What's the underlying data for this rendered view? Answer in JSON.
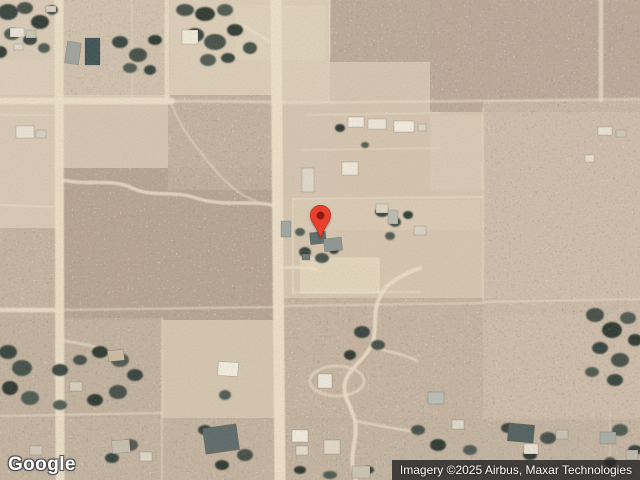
{
  "page": {
    "width": 640,
    "height": 480,
    "view": "satellite-map"
  },
  "logo": {
    "text": "Google"
  },
  "attribution": {
    "text": "Imagery ©2025 Airbus, Maxar Technologies",
    "background": "#242424",
    "text_color": "#ffffff"
  },
  "map": {
    "type": "satellite",
    "marker": {
      "name": "location-pin",
      "x": 320,
      "tip_y": 240,
      "width": 23,
      "height": 36,
      "color": "#e8402d",
      "stroke": "#b32b1a",
      "dot_color": "#8e1a0c"
    },
    "palette": {
      "terrain_base": "#d5c5b2",
      "road": "#ecdfc8",
      "scrub_dark": "#5c4d3f",
      "scrub_light": "#f0e5d2",
      "tree": "#2e3b36",
      "boundary": "#ede2cc"
    }
  },
  "map_features": {
    "regions": [
      {
        "x": 0,
        "y": 0,
        "w": 170,
        "h": 102,
        "fill": "#d9cbb6"
      },
      {
        "x": 170,
        "y": 0,
        "w": 160,
        "h": 102,
        "fill": "#dccEb8"
      },
      {
        "x": 235,
        "y": 5,
        "w": 90,
        "h": 55,
        "fill": "#dfd2bc"
      },
      {
        "x": 0,
        "y": 60,
        "w": 55,
        "h": 40,
        "fill": "#dcceba"
      },
      {
        "x": 330,
        "y": 100,
        "w": 155,
        "h": 100,
        "fill": "#d5c5b0"
      },
      {
        "x": 430,
        "y": 115,
        "w": 55,
        "h": 75,
        "fill": "#d9c9b5"
      },
      {
        "x": 483,
        "y": 103,
        "w": 157,
        "h": 210,
        "fill": "#d5c3b2"
      },
      {
        "x": 283,
        "y": 195,
        "w": 200,
        "h": 110,
        "fill": "#d6c6b1"
      },
      {
        "x": 295,
        "y": 200,
        "w": 185,
        "h": 30,
        "fill": "#dacbb5"
      },
      {
        "x": 300,
        "y": 258,
        "w": 80,
        "h": 36,
        "fill": "#e3d6be"
      },
      {
        "x": 160,
        "y": 318,
        "w": 125,
        "h": 162,
        "fill": "#d5c6b0"
      },
      {
        "x": 300,
        "y": 365,
        "w": 70,
        "h": 34,
        "fill": "#dfd2ba"
      },
      {
        "x": 0,
        "y": 95,
        "w": 58,
        "h": 140,
        "fill": "#d8cab5"
      },
      {
        "x": 495,
        "y": 330,
        "w": 100,
        "h": 60,
        "fill": "#d6c6b2"
      }
    ],
    "scrub": [
      {
        "x": 330,
        "y": 0,
        "w": 310,
        "h": 62,
        "fill": "#bcaa99",
        "o": 0.95
      },
      {
        "x": 430,
        "y": 0,
        "w": 210,
        "h": 112,
        "fill": "#bba898",
        "o": 0.95
      },
      {
        "x": 483,
        "y": 100,
        "w": 157,
        "h": 215,
        "fill": "#cdbcab",
        "o": 0.75
      },
      {
        "x": 57,
        "y": 168,
        "w": 218,
        "h": 152,
        "fill": "#b7a592",
        "o": 1
      },
      {
        "x": 168,
        "y": 95,
        "w": 110,
        "h": 95,
        "fill": "#c2b09e",
        "o": 0.9
      },
      {
        "x": 0,
        "y": 228,
        "w": 57,
        "h": 92,
        "fill": "#c2b2a0",
        "o": 0.9
      },
      {
        "x": 0,
        "y": 318,
        "w": 162,
        "h": 100,
        "fill": "#c0af9c",
        "o": 0.9
      },
      {
        "x": 283,
        "y": 298,
        "w": 200,
        "h": 122,
        "fill": "#c3b19e",
        "o": 0.9
      },
      {
        "x": 0,
        "y": 418,
        "w": 640,
        "h": 62,
        "fill": "#c2b19f",
        "o": 0.9
      },
      {
        "x": 483,
        "y": 298,
        "w": 157,
        "h": 122,
        "fill": "#cbbaa7",
        "o": 0.85
      },
      {
        "x": 57,
        "y": 0,
        "w": 113,
        "h": 95,
        "fill": "#cdbdaa",
        "o": 0.65
      }
    ],
    "boundaries": [
      {
        "d": "M172,101 L283,102",
        "w": 3,
        "o": 0.55
      },
      {
        "d": "M283,103 L640,99",
        "w": 3,
        "o": 0.5
      },
      {
        "d": "M132,0 L132,98",
        "w": 1.5,
        "o": 0.4
      },
      {
        "d": "M57,310 L276,307",
        "w": 2.5,
        "o": 0.5
      },
      {
        "d": "M280,306 L483,303",
        "w": 2.5,
        "o": 0.45
      },
      {
        "d": "M483,302 L640,299",
        "w": 2.5,
        "o": 0.45
      },
      {
        "d": "M483,108 L483,300",
        "w": 2,
        "o": 0.45
      },
      {
        "d": "M293,199 L483,197",
        "w": 2,
        "o": 0.55
      },
      {
        "d": "M293,199 L293,294",
        "w": 2,
        "o": 0.55
      },
      {
        "d": "M293,292 L420,292",
        "w": 2,
        "o": 0.5
      },
      {
        "d": "M298,258 L378,258 L378,292",
        "w": 1.2,
        "o": 0.5
      },
      {
        "d": "M162,318 L162,480",
        "w": 2,
        "o": 0.45
      },
      {
        "d": "M0,416 L162,413",
        "w": 2.5,
        "o": 0.5
      },
      {
        "d": "M0,115 L55,115",
        "w": 1.5,
        "o": 0.5
      },
      {
        "d": "M0,205 L57,207",
        "w": 2,
        "o": 0.5
      },
      {
        "d": "M330,0 L330,58",
        "w": 2,
        "o": 0.4
      },
      {
        "d": "M305,115 L440,113",
        "w": 1.5,
        "o": 0.5
      },
      {
        "d": "M302,150 L440,148",
        "w": 1.5,
        "o": 0.45
      },
      {
        "d": "M610,412 L610,480",
        "w": 1.5,
        "o": 0.4
      }
    ],
    "roads": [
      {
        "d": "M276,0 C276,90 277,180 278,260 C279,340 280,420 280,480",
        "w": 11,
        "o": 1
      },
      {
        "d": "M59,0 L60,480",
        "w": 9,
        "o": 0.95
      },
      {
        "d": "M0,101 L172,101",
        "w": 6.5,
        "o": 0.95
      },
      {
        "d": "M167,0 L167,101",
        "w": 5,
        "o": 0.8
      },
      {
        "d": "M0,310 L57,310",
        "w": 4.5,
        "o": 0.85
      },
      {
        "d": "M601,0 L601,100",
        "w": 4.5,
        "o": 0.7
      },
      {
        "d": "M62,180 C90,186 112,178 132,188 C154,198 172,190 196,198 C224,207 248,200 272,205",
        "w": 3.5,
        "o": 0.8
      },
      {
        "d": "M270,42 C254,32 243,23 233,25",
        "w": 3.5,
        "o": 0.65
      },
      {
        "d": "M282,268 C296,267 306,267 316,269",
        "w": 3,
        "o": 0.7
      },
      {
        "d": "M420,268 C398,276 383,286 379,299 C372,314 378,332 371,347 C361,363 348,369 345,383 C342,396 352,407 355,421 C358,438 350,452 353,468 L356,480",
        "w": 4,
        "o": 0.85
      },
      {
        "d": "M371,347 C390,352 404,354 417,361",
        "w": 3,
        "o": 0.6
      },
      {
        "d": "M355,421 C380,426 400,429 420,433",
        "w": 3,
        "o": 0.6
      },
      {
        "d": "M310,381 a27,15 0 1 0 54,0 a27,15 0 1 0 -54,0",
        "w": 3,
        "o": 0.6
      },
      {
        "d": "M58,340 C80,343 96,346 106,351",
        "w": 3,
        "o": 0.6
      },
      {
        "d": "M171,103 C182,132 200,152 216,171 C228,185 242,196 256,201",
        "w": 2.5,
        "o": 0.45
      }
    ],
    "trees": [
      {
        "x": 8,
        "y": 12,
        "rx": 10,
        "ry": 8
      },
      {
        "x": 25,
        "y": 8,
        "rx": 8,
        "ry": 6
      },
      {
        "x": 40,
        "y": 22,
        "rx": 9,
        "ry": 7
      },
      {
        "x": 12,
        "y": 34,
        "rx": 8,
        "ry": 6
      },
      {
        "x": 30,
        "y": 40,
        "rx": 7,
        "ry": 5
      },
      {
        "x": 52,
        "y": 10,
        "rx": 6,
        "ry": 5
      },
      {
        "x": 0,
        "y": 52,
        "rx": 7,
        "ry": 6
      },
      {
        "x": 44,
        "y": 48,
        "rx": 6,
        "ry": 5
      },
      {
        "x": 120,
        "y": 42,
        "rx": 8,
        "ry": 6
      },
      {
        "x": 138,
        "y": 55,
        "rx": 9,
        "ry": 7
      },
      {
        "x": 155,
        "y": 40,
        "rx": 7,
        "ry": 5
      },
      {
        "x": 130,
        "y": 68,
        "rx": 7,
        "ry": 5
      },
      {
        "x": 150,
        "y": 70,
        "rx": 6,
        "ry": 5
      },
      {
        "x": 185,
        "y": 10,
        "rx": 9,
        "ry": 6
      },
      {
        "x": 205,
        "y": 14,
        "rx": 10,
        "ry": 7
      },
      {
        "x": 225,
        "y": 10,
        "rx": 8,
        "ry": 6
      },
      {
        "x": 195,
        "y": 35,
        "rx": 9,
        "ry": 7
      },
      {
        "x": 215,
        "y": 42,
        "rx": 11,
        "ry": 8
      },
      {
        "x": 235,
        "y": 30,
        "rx": 8,
        "ry": 6
      },
      {
        "x": 208,
        "y": 60,
        "rx": 8,
        "ry": 6
      },
      {
        "x": 228,
        "y": 58,
        "rx": 7,
        "ry": 5
      },
      {
        "x": 250,
        "y": 48,
        "rx": 7,
        "ry": 6
      },
      {
        "x": 340,
        "y": 128,
        "rx": 5,
        "ry": 4
      },
      {
        "x": 365,
        "y": 145,
        "rx": 4,
        "ry": 3
      },
      {
        "x": 382,
        "y": 212,
        "rx": 7,
        "ry": 5
      },
      {
        "x": 395,
        "y": 222,
        "rx": 6,
        "ry": 5
      },
      {
        "x": 408,
        "y": 215,
        "rx": 5,
        "ry": 4
      },
      {
        "x": 390,
        "y": 236,
        "rx": 5,
        "ry": 4
      },
      {
        "x": 305,
        "y": 252,
        "rx": 6,
        "ry": 5
      },
      {
        "x": 322,
        "y": 258,
        "rx": 7,
        "ry": 5
      },
      {
        "x": 334,
        "y": 250,
        "rx": 5,
        "ry": 4
      },
      {
        "x": 300,
        "y": 232,
        "rx": 5,
        "ry": 4
      },
      {
        "x": 8,
        "y": 352,
        "rx": 9,
        "ry": 7
      },
      {
        "x": 22,
        "y": 368,
        "rx": 10,
        "ry": 8
      },
      {
        "x": 10,
        "y": 388,
        "rx": 8,
        "ry": 7
      },
      {
        "x": 30,
        "y": 398,
        "rx": 9,
        "ry": 7
      },
      {
        "x": 60,
        "y": 370,
        "rx": 8,
        "ry": 6
      },
      {
        "x": 80,
        "y": 360,
        "rx": 7,
        "ry": 5
      },
      {
        "x": 100,
        "y": 352,
        "rx": 8,
        "ry": 6
      },
      {
        "x": 120,
        "y": 360,
        "rx": 9,
        "ry": 7
      },
      {
        "x": 135,
        "y": 375,
        "rx": 8,
        "ry": 6
      },
      {
        "x": 118,
        "y": 392,
        "rx": 9,
        "ry": 7
      },
      {
        "x": 95,
        "y": 400,
        "rx": 8,
        "ry": 6
      },
      {
        "x": 60,
        "y": 405,
        "rx": 7,
        "ry": 5
      },
      {
        "x": 362,
        "y": 332,
        "rx": 8,
        "ry": 6
      },
      {
        "x": 378,
        "y": 345,
        "rx": 7,
        "ry": 5
      },
      {
        "x": 350,
        "y": 355,
        "rx": 6,
        "ry": 5
      },
      {
        "x": 225,
        "y": 395,
        "rx": 6,
        "ry": 5
      },
      {
        "x": 205,
        "y": 430,
        "rx": 7,
        "ry": 5
      },
      {
        "x": 245,
        "y": 455,
        "rx": 8,
        "ry": 6
      },
      {
        "x": 222,
        "y": 465,
        "rx": 7,
        "ry": 5
      },
      {
        "x": 130,
        "y": 445,
        "rx": 8,
        "ry": 6
      },
      {
        "x": 112,
        "y": 458,
        "rx": 7,
        "ry": 5
      },
      {
        "x": 418,
        "y": 430,
        "rx": 7,
        "ry": 5
      },
      {
        "x": 438,
        "y": 445,
        "rx": 8,
        "ry": 6
      },
      {
        "x": 470,
        "y": 450,
        "rx": 7,
        "ry": 5
      },
      {
        "x": 508,
        "y": 428,
        "rx": 7,
        "ry": 5
      },
      {
        "x": 548,
        "y": 438,
        "rx": 8,
        "ry": 6
      },
      {
        "x": 530,
        "y": 455,
        "rx": 7,
        "ry": 5
      },
      {
        "x": 620,
        "y": 430,
        "rx": 8,
        "ry": 6
      },
      {
        "x": 635,
        "y": 450,
        "rx": 7,
        "ry": 5
      },
      {
        "x": 610,
        "y": 462,
        "rx": 6,
        "ry": 5
      },
      {
        "x": 300,
        "y": 470,
        "rx": 6,
        "ry": 4
      },
      {
        "x": 330,
        "y": 475,
        "rx": 7,
        "ry": 4
      },
      {
        "x": 368,
        "y": 470,
        "rx": 6,
        "ry": 4
      },
      {
        "x": 595,
        "y": 315,
        "rx": 9,
        "ry": 7
      },
      {
        "x": 612,
        "y": 330,
        "rx": 10,
        "ry": 8
      },
      {
        "x": 628,
        "y": 318,
        "rx": 8,
        "ry": 6
      },
      {
        "x": 600,
        "y": 348,
        "rx": 8,
        "ry": 6
      },
      {
        "x": 620,
        "y": 360,
        "rx": 9,
        "ry": 7
      },
      {
        "x": 635,
        "y": 340,
        "rx": 7,
        "ry": 6
      },
      {
        "x": 592,
        "y": 372,
        "rx": 7,
        "ry": 5
      },
      {
        "x": 615,
        "y": 380,
        "rx": 8,
        "ry": 6
      }
    ],
    "buildings": [
      {
        "x": 10,
        "y": 28,
        "w": 14,
        "h": 9,
        "fill": "#e9e4d8",
        "rot": 0
      },
      {
        "x": 26,
        "y": 30,
        "w": 10,
        "h": 8,
        "fill": "#c9c4b8",
        "rot": 0
      },
      {
        "x": 14,
        "y": 44,
        "w": 9,
        "h": 6,
        "fill": "#ddd8cc",
        "rot": 0
      },
      {
        "x": 46,
        "y": 6,
        "w": 10,
        "h": 6,
        "fill": "#d8d2c4",
        "rot": 0
      },
      {
        "x": 66,
        "y": 42,
        "w": 14,
        "h": 22,
        "fill": "#9fa49f",
        "rot": 8
      },
      {
        "x": 85,
        "y": 38,
        "w": 15,
        "h": 27,
        "fill": "#3e5456",
        "rot": 0
      },
      {
        "x": 182,
        "y": 30,
        "w": 16,
        "h": 14,
        "fill": "#efead9",
        "rot": 0
      },
      {
        "x": 16,
        "y": 126,
        "w": 18,
        "h": 12,
        "fill": "#e9e3d4",
        "rot": 0
      },
      {
        "x": 36,
        "y": 130,
        "w": 10,
        "h": 8,
        "fill": "#d6cfbf",
        "rot": 0
      },
      {
        "x": 348,
        "y": 117,
        "w": 16,
        "h": 10,
        "fill": "#f0ebde",
        "rot": 0
      },
      {
        "x": 368,
        "y": 119,
        "w": 18,
        "h": 10,
        "fill": "#ede7da",
        "rot": 0
      },
      {
        "x": 394,
        "y": 121,
        "w": 20,
        "h": 11,
        "fill": "#f2ede0",
        "rot": 0
      },
      {
        "x": 418,
        "y": 124,
        "w": 8,
        "h": 7,
        "fill": "#dcd5c5",
        "rot": 0
      },
      {
        "x": 342,
        "y": 162,
        "w": 16,
        "h": 13,
        "fill": "#efe9db",
        "rot": 0
      },
      {
        "x": 302,
        "y": 168,
        "w": 12,
        "h": 24,
        "fill": "#dfd9ca",
        "rot": 0
      },
      {
        "x": 598,
        "y": 127,
        "w": 14,
        "h": 8,
        "fill": "#e8e2d4",
        "rot": 0
      },
      {
        "x": 616,
        "y": 130,
        "w": 10,
        "h": 7,
        "fill": "#cfc8b8",
        "rot": 0
      },
      {
        "x": 585,
        "y": 155,
        "w": 9,
        "h": 7,
        "fill": "#e6e0d2",
        "rot": 0
      },
      {
        "x": 281,
        "y": 221,
        "w": 10,
        "h": 16,
        "fill": "#9fa8a2",
        "rot": 0
      },
      {
        "x": 310,
        "y": 232,
        "w": 16,
        "h": 12,
        "fill": "#5b6e6e",
        "rot": -6
      },
      {
        "x": 324,
        "y": 238,
        "w": 18,
        "h": 13,
        "fill": "#8e9794",
        "rot": -6
      },
      {
        "x": 302,
        "y": 254,
        "w": 8,
        "h": 6,
        "fill": "#6e7b78",
        "rot": 0
      },
      {
        "x": 376,
        "y": 204,
        "w": 12,
        "h": 9,
        "fill": "#dcd6c6",
        "rot": 0
      },
      {
        "x": 388,
        "y": 210,
        "w": 10,
        "h": 14,
        "fill": "#b9bdb4",
        "rot": 0
      },
      {
        "x": 414,
        "y": 226,
        "w": 12,
        "h": 9,
        "fill": "#d8d2c2",
        "rot": 0
      },
      {
        "x": 108,
        "y": 350,
        "w": 16,
        "h": 11,
        "fill": "#c9bba2",
        "rot": -6
      },
      {
        "x": 70,
        "y": 382,
        "w": 12,
        "h": 9,
        "fill": "#d8d0be",
        "rot": 0
      },
      {
        "x": 218,
        "y": 362,
        "w": 20,
        "h": 14,
        "fill": "#f1ecdf",
        "rot": 3
      },
      {
        "x": 318,
        "y": 374,
        "w": 14,
        "h": 14,
        "fill": "#ede7d9",
        "rot": 0
      },
      {
        "x": 204,
        "y": 426,
        "w": 34,
        "h": 26,
        "fill": "#5e6b6b",
        "rot": -8
      },
      {
        "x": 292,
        "y": 430,
        "w": 16,
        "h": 12,
        "fill": "#efeadc",
        "rot": 0
      },
      {
        "x": 296,
        "y": 446,
        "w": 12,
        "h": 9,
        "fill": "#e3dccb",
        "rot": 0
      },
      {
        "x": 324,
        "y": 440,
        "w": 16,
        "h": 14,
        "fill": "#dfd8c7",
        "rot": 0
      },
      {
        "x": 352,
        "y": 466,
        "w": 18,
        "h": 12,
        "fill": "#cbc4b2",
        "rot": 0
      },
      {
        "x": 428,
        "y": 392,
        "w": 16,
        "h": 12,
        "fill": "#b9beb6",
        "rot": 0
      },
      {
        "x": 452,
        "y": 420,
        "w": 12,
        "h": 9,
        "fill": "#ded8c8",
        "rot": 0
      },
      {
        "x": 508,
        "y": 424,
        "w": 26,
        "h": 18,
        "fill": "#52625f",
        "rot": 5
      },
      {
        "x": 524,
        "y": 444,
        "w": 14,
        "h": 10,
        "fill": "#e8e2d4",
        "rot": 0
      },
      {
        "x": 556,
        "y": 430,
        "w": 12,
        "h": 9,
        "fill": "#c8c2b2",
        "rot": 0
      },
      {
        "x": 600,
        "y": 432,
        "w": 16,
        "h": 12,
        "fill": "#a7aea7",
        "rot": 0
      },
      {
        "x": 626,
        "y": 450,
        "w": 12,
        "h": 10,
        "fill": "#bfb9aa",
        "rot": 0
      },
      {
        "x": 112,
        "y": 440,
        "w": 18,
        "h": 13,
        "fill": "#c6bfb0",
        "rot": -5
      },
      {
        "x": 140,
        "y": 452,
        "w": 12,
        "h": 9,
        "fill": "#ddd6c5",
        "rot": 0
      },
      {
        "x": 30,
        "y": 446,
        "w": 12,
        "h": 9,
        "fill": "#d1caba",
        "rot": 0
      }
    ]
  }
}
